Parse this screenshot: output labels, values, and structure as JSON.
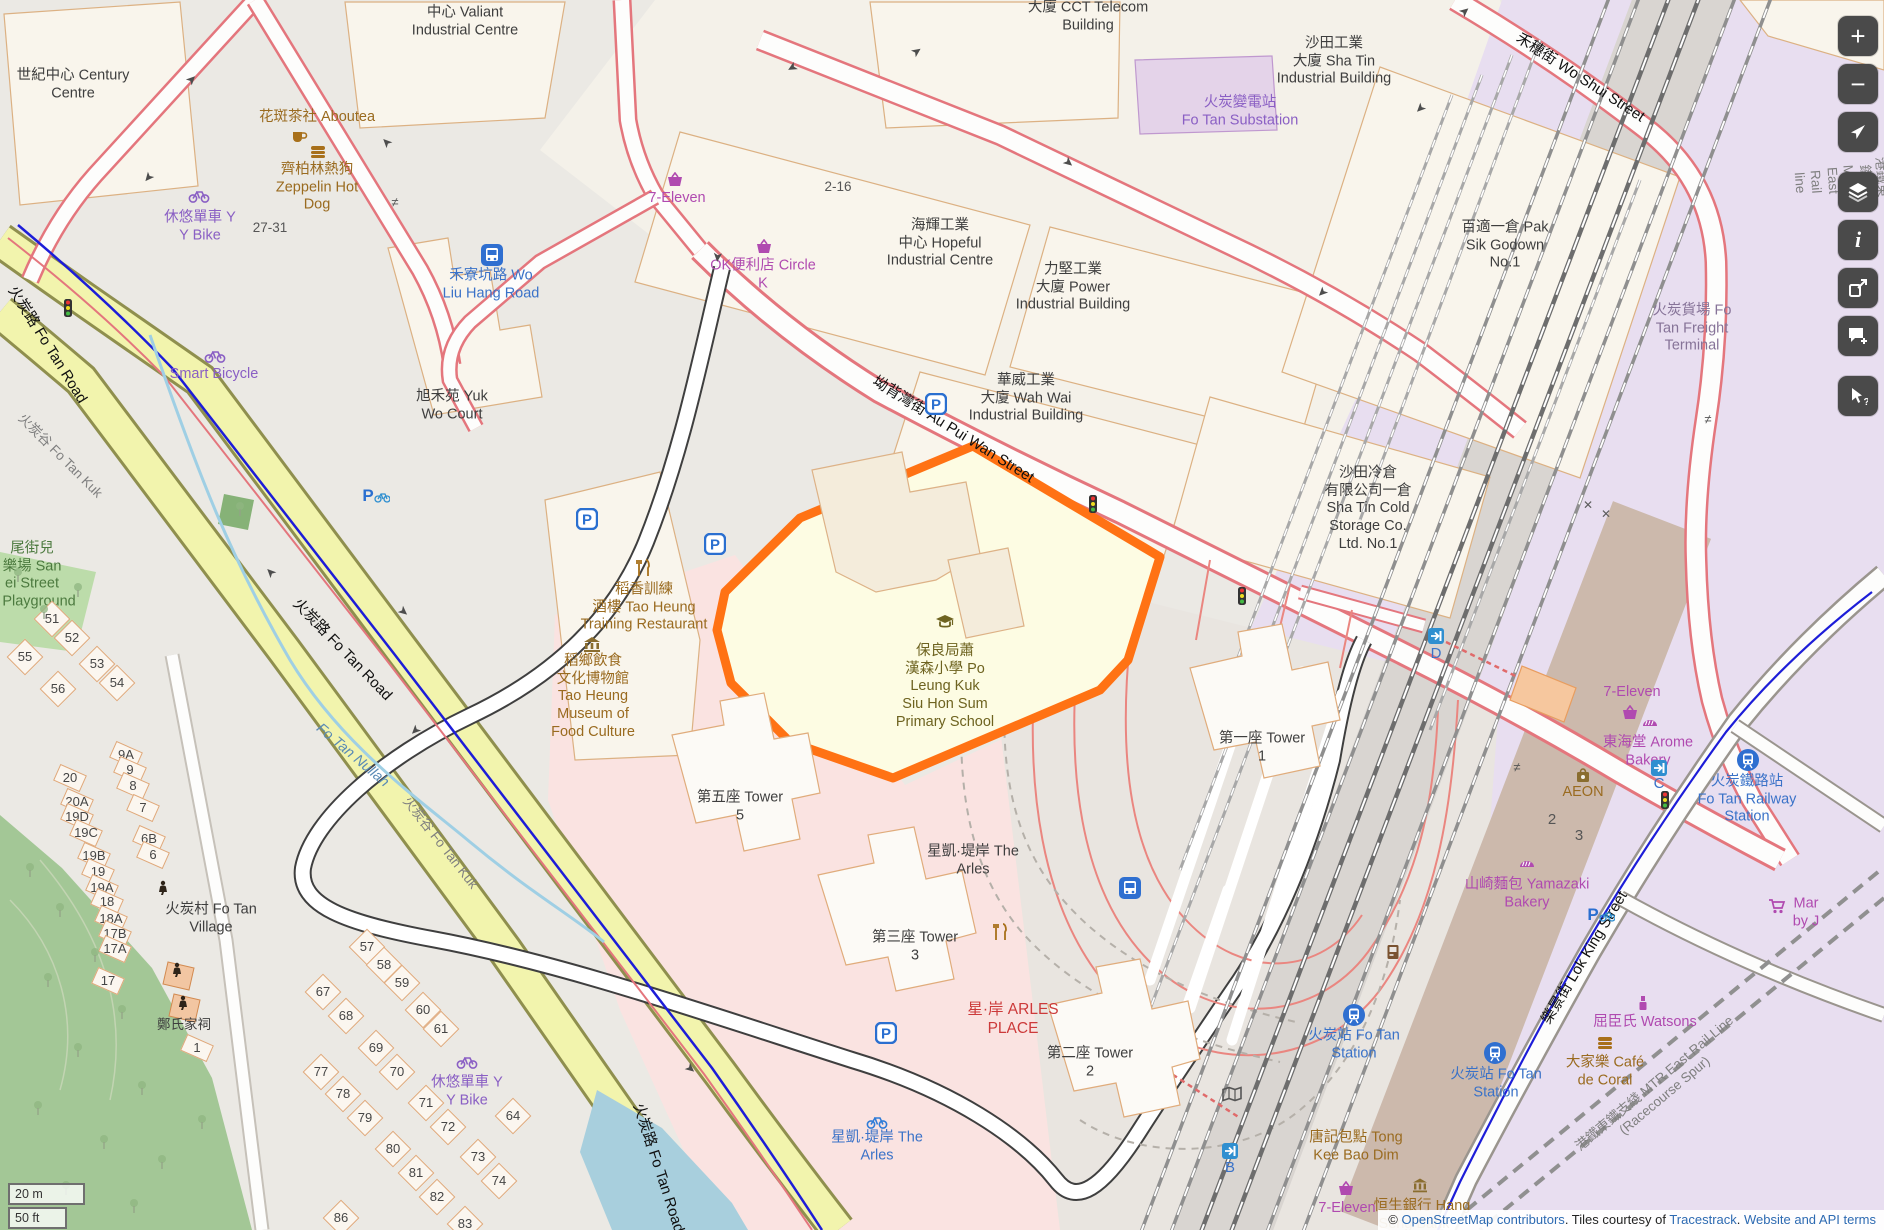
{
  "map": {
    "attribution": {
      "prefix": "© ",
      "link_osm": "OpenStreetMap contributors",
      "middle": ". Tiles courtesy of ",
      "link_tiles": "Tracestrack",
      "sep": ". ",
      "link_terms": "Website and API terms"
    },
    "scale": {
      "metric": "20 m",
      "imperial": "50 ft"
    },
    "colors": {
      "highlight": "#ff7214",
      "school_fill": "#fdfce3",
      "rail_land": "#e8def0",
      "water": "#a8cfdd"
    },
    "controls": {
      "groups": [
        {
          "items": [
            {
              "id": "zoom-in",
              "g": "plus"
            },
            {
              "id": "zoom-out",
              "g": "minus"
            },
            {
              "id": "locate",
              "g": "nav"
            }
          ]
        },
        {
          "items": [
            {
              "id": "layers",
              "g": "layers"
            },
            {
              "id": "legend",
              "g": "info"
            },
            {
              "id": "share",
              "g": "share"
            },
            {
              "id": "note",
              "g": "note"
            }
          ]
        },
        {
          "items": [
            {
              "id": "query-features",
              "g": "query"
            }
          ]
        }
      ]
    }
  },
  "labels": [
    {
      "t": [
        "世紀中心 Century",
        "Centre"
      ],
      "x": 73,
      "y": 85,
      "c": "place"
    },
    {
      "t": [
        "中心 Valiant",
        "Industrial Centre"
      ],
      "x": 465,
      "y": 22,
      "c": "place"
    },
    {
      "t": [
        "大廈 CCT Telecom",
        "Building"
      ],
      "x": 1088,
      "y": 17,
      "c": "place"
    },
    {
      "t": [
        "沙田工業",
        "大廈 Sha Tin",
        "Industrial Building"
      ],
      "x": 1334,
      "y": 62,
      "c": "place"
    },
    {
      "t": [
        "百適一倉 Pak",
        "Sik Godown",
        "No.1"
      ],
      "x": 1505,
      "y": 246,
      "c": "place"
    },
    {
      "t": [
        "海輝工業",
        "中心 Hopeful",
        "Industrial Centre"
      ],
      "x": 940,
      "y": 244,
      "c": "place"
    },
    {
      "t": [
        "力堅工業",
        "大廈 Power",
        "Industrial Building"
      ],
      "x": 1073,
      "y": 288,
      "c": "place"
    },
    {
      "t": [
        "華威工業",
        "大廈 Wah Wai",
        "Industrial Building"
      ],
      "x": 1026,
      "y": 399,
      "c": "place"
    },
    {
      "t": [
        "沙田冷倉",
        "有限公司一倉",
        "Sha Tin Cold",
        "Storage Co.",
        "Ltd. No.1"
      ],
      "x": 1368,
      "y": 509,
      "c": "place"
    },
    {
      "t": [
        "旭禾苑 Yuk",
        "Wo Court"
      ],
      "x": 452,
      "y": 406,
      "c": "place"
    },
    {
      "t": [
        "第五座 Tower",
        "5"
      ],
      "x": 740,
      "y": 807,
      "c": "place"
    },
    {
      "t": [
        "星凱·堤岸 The",
        "Arles"
      ],
      "x": 973,
      "y": 861,
      "c": "place"
    },
    {
      "t": [
        "第三座 Tower",
        "3"
      ],
      "x": 915,
      "y": 947,
      "c": "place"
    },
    {
      "t": [
        "第二座 Tower",
        "2"
      ],
      "x": 1090,
      "y": 1063,
      "c": "place"
    },
    {
      "t": [
        "第一座 Tower",
        "1"
      ],
      "x": 1262,
      "y": 748,
      "c": "place"
    },
    {
      "t": [
        "火炭村 Fo Tan",
        "Village"
      ],
      "x": 211,
      "y": 919,
      "c": "place"
    },
    {
      "t": [
        "保良局蕭",
        "漢森小學 Po",
        "Leung Kuk",
        "Siu Hon Sum",
        "Primary School"
      ],
      "x": 945,
      "y": 687,
      "c": "school"
    },
    {
      "t": "27-31",
      "x": 270,
      "y": 228,
      "c": "numplain"
    },
    {
      "t": "2-16",
      "x": 838,
      "y": 187,
      "c": "numplain"
    },
    {
      "t": "2",
      "x": 1552,
      "y": 820,
      "c": "numplain",
      "s": 15
    },
    {
      "t": "3",
      "x": 1579,
      "y": 836,
      "c": "numplain",
      "s": 15
    },
    {
      "t": "火炭路 Fo Tan Road",
      "x": 47,
      "y": 345,
      "c": "street",
      "r": 58
    },
    {
      "t": "火炭路 Fo Tan Road",
      "x": 342,
      "y": 650,
      "c": "street",
      "r": 46
    },
    {
      "t": "火炭路 Fo Tan Road",
      "x": 658,
      "y": 1168,
      "c": "street",
      "r": 72
    },
    {
      "t": "坳背灣街 Au Pui Wan Street",
      "x": 953,
      "y": 430,
      "c": "street",
      "r": 32
    },
    {
      "t": "禾穗街 Wo Shui Street",
      "x": 1580,
      "y": 78,
      "c": "street",
      "r": 33
    },
    {
      "t": "樂景街 Lok King Street",
      "x": 1585,
      "y": 958,
      "c": "street",
      "r": -59
    },
    {
      "t": "花斑茶社 Aboutea",
      "x": 317,
      "y": 118,
      "c": "poib"
    },
    {
      "t": [
        "齊柏林熱狗",
        "Zeppelin Hot",
        "Dog"
      ],
      "x": 317,
      "y": 188,
      "c": "poib"
    },
    {
      "t": [
        "稻香訓練",
        "酒樓 Tao Heung",
        "Training Restaurant"
      ],
      "x": 644,
      "y": 608,
      "c": "poib"
    },
    {
      "t": [
        "稻鄉飲食",
        "文化博物館",
        "Tao Heung",
        "Museum of",
        "Food Culture"
      ],
      "x": 593,
      "y": 697,
      "c": "poib"
    },
    {
      "t": "AEON",
      "x": 1583,
      "y": 793,
      "c": "poib"
    },
    {
      "t": [
        "大家樂 Café",
        "de Coral"
      ],
      "x": 1605,
      "y": 1072,
      "c": "poib"
    },
    {
      "t": [
        "唐記包點 Tong",
        "Kee Bao Dim"
      ],
      "x": 1356,
      "y": 1147,
      "c": "poib"
    },
    {
      "t": "恒生銀行 Hang",
      "x": 1422,
      "y": 1207,
      "c": "poib"
    },
    {
      "t": "Seng Bank",
      "x": 1414,
      "y": 1225,
      "c": "poib"
    },
    {
      "t": "7-Eleven",
      "x": 677,
      "y": 199,
      "c": "poip"
    },
    {
      "t": [
        "OK便利店 Circle",
        "K"
      ],
      "x": 763,
      "y": 275,
      "c": "poip"
    },
    {
      "t": "Smart Bicycle",
      "x": 214,
      "y": 375,
      "c": "poiv"
    },
    {
      "t": [
        "休悠單車 Y",
        "Y Bike"
      ],
      "x": 200,
      "y": 227,
      "c": "poiv"
    },
    {
      "t": [
        "休悠單車 Y",
        "Y Bike"
      ],
      "x": 467,
      "y": 1092,
      "c": "poiv"
    },
    {
      "t": [
        "火炭變電站",
        "Fo Tan Substation"
      ],
      "x": 1240,
      "y": 112,
      "c": "poiv"
    },
    {
      "t": [
        "山崎麵包 Yamazaki",
        "Bakery"
      ],
      "x": 1527,
      "y": 894,
      "c": "poip"
    },
    {
      "t": [
        "東海堂 Arome",
        "Bakery"
      ],
      "x": 1648,
      "y": 752,
      "c": "poip"
    },
    {
      "t": "7-Eleven",
      "x": 1632,
      "y": 693,
      "c": "poip"
    },
    {
      "t": "7-Eleven",
      "x": 1347,
      "y": 1209,
      "c": "poip"
    },
    {
      "t": "屈臣氏 Watsons",
      "x": 1645,
      "y": 1023,
      "c": "poip"
    },
    {
      "t": [
        "Mar",
        "by J"
      ],
      "x": 1806,
      "y": 913,
      "c": "poip"
    },
    {
      "t": [
        "火炭貨場 Fo",
        "Tan Freight",
        "Terminal"
      ],
      "x": 1692,
      "y": 329,
      "c": "railp"
    },
    {
      "t": [
        "禾寮坑路 Wo",
        "Liu Hang Road"
      ],
      "x": 491,
      "y": 285,
      "c": "poibl"
    },
    {
      "t": [
        "火炭鐵路站",
        "Fo Tan Railway",
        "Station"
      ],
      "x": 1747,
      "y": 800,
      "c": "poibl"
    },
    {
      "t": [
        "火炭站 Fo Tan",
        "Station"
      ],
      "x": 1354,
      "y": 1045,
      "c": "poibl"
    },
    {
      "t": [
        "火炭站 Fo Tan",
        "Station"
      ],
      "x": 1496,
      "y": 1084,
      "c": "poibl"
    },
    {
      "t": [
        "星凱·堤岸 The",
        "Arles"
      ],
      "x": 877,
      "y": 1147,
      "c": "poibl"
    },
    {
      "t": "D",
      "x": 1436,
      "y": 654,
      "c": "poibl",
      "s": 15
    },
    {
      "t": "B",
      "x": 1230,
      "y": 1168,
      "c": "poibl",
      "s": 15
    },
    {
      "t": "C",
      "x": 1659,
      "y": 784,
      "c": "poibl",
      "s": 15
    },
    {
      "t": [
        "星·岸 ARLES",
        "PLACE"
      ],
      "x": 1013,
      "y": 1020,
      "c": "poir"
    },
    {
      "t": [
        "尾街兒",
        "樂場 San",
        "ei Street",
        "'s Playground"
      ],
      "x": 32,
      "y": 576,
      "c": "poig"
    },
    {
      "t": "Fo Tan Nullah",
      "x": 352,
      "y": 756,
      "c": "wat",
      "r": 40
    },
    {
      "t": "火炭谷 Fo Tan Kuk",
      "x": 60,
      "y": 456,
      "c": "gry",
      "r": 45
    },
    {
      "t": "火炭谷 Fo Tan Kuk",
      "x": 440,
      "y": 843,
      "c": "gry",
      "r": 52
    },
    {
      "t": "港鐵東鐵綫 MTR East Rail line",
      "x": 1840,
      "y": 180,
      "c": "gry",
      "r": 86
    },
    {
      "t": "港鐵東鐵支綫 MTR East Rail Line (Racecourse Spur)",
      "x": 1660,
      "y": 1090,
      "c": "gry",
      "r": -40
    },
    {
      "t": "51",
      "x": 52,
      "y": 619,
      "c": "num"
    },
    {
      "t": "52",
      "x": 72,
      "y": 638,
      "c": "num"
    },
    {
      "t": "55",
      "x": 25,
      "y": 657,
      "c": "num"
    },
    {
      "t": "53",
      "x": 97,
      "y": 664,
      "c": "num"
    },
    {
      "t": "54",
      "x": 117,
      "y": 683,
      "c": "num"
    },
    {
      "t": "56",
      "x": 58,
      "y": 689,
      "c": "num"
    },
    {
      "t": "57",
      "x": 367,
      "y": 947,
      "c": "num"
    },
    {
      "t": "58",
      "x": 384,
      "y": 965,
      "c": "num"
    },
    {
      "t": "59",
      "x": 402,
      "y": 983,
      "c": "num"
    },
    {
      "t": "60",
      "x": 423,
      "y": 1010,
      "c": "num"
    },
    {
      "t": "61",
      "x": 441,
      "y": 1029,
      "c": "num"
    },
    {
      "t": "67",
      "x": 323,
      "y": 992,
      "c": "num"
    },
    {
      "t": "68",
      "x": 346,
      "y": 1016,
      "c": "num"
    },
    {
      "t": "69",
      "x": 376,
      "y": 1048,
      "c": "num"
    },
    {
      "t": "70",
      "x": 397,
      "y": 1072,
      "c": "num"
    },
    {
      "t": "71",
      "x": 426,
      "y": 1103,
      "c": "num"
    },
    {
      "t": "72",
      "x": 448,
      "y": 1127,
      "c": "num"
    },
    {
      "t": "64",
      "x": 513,
      "y": 1116,
      "c": "num"
    },
    {
      "t": "73",
      "x": 478,
      "y": 1157,
      "c": "num"
    },
    {
      "t": "74",
      "x": 499,
      "y": 1181,
      "c": "num"
    },
    {
      "t": "77",
      "x": 321,
      "y": 1072,
      "c": "num"
    },
    {
      "t": "78",
      "x": 343,
      "y": 1094,
      "c": "num"
    },
    {
      "t": "79",
      "x": 365,
      "y": 1118,
      "c": "num"
    },
    {
      "t": "80",
      "x": 393,
      "y": 1149,
      "c": "num"
    },
    {
      "t": "81",
      "x": 416,
      "y": 1173,
      "c": "num"
    },
    {
      "t": "82",
      "x": 437,
      "y": 1197,
      "c": "num"
    },
    {
      "t": "86",
      "x": 341,
      "y": 1218,
      "c": "num"
    },
    {
      "t": "83",
      "x": 465,
      "y": 1224,
      "c": "num"
    },
    {
      "t": "20",
      "x": 70,
      "y": 778,
      "c": "numr"
    },
    {
      "t": "20A",
      "x": 77,
      "y": 802,
      "c": "numr"
    },
    {
      "t": "19D",
      "x": 77,
      "y": 817,
      "c": "numr"
    },
    {
      "t": "19C",
      "x": 86,
      "y": 833,
      "c": "numr"
    },
    {
      "t": "19B",
      "x": 94,
      "y": 856,
      "c": "numr"
    },
    {
      "t": "19",
      "x": 98,
      "y": 872,
      "c": "numr"
    },
    {
      "t": "19A",
      "x": 102,
      "y": 888,
      "c": "numr"
    },
    {
      "t": "18",
      "x": 107,
      "y": 902,
      "c": "numr"
    },
    {
      "t": "18A",
      "x": 111,
      "y": 919,
      "c": "numr"
    },
    {
      "t": "17B",
      "x": 115,
      "y": 934,
      "c": "numr"
    },
    {
      "t": "17A",
      "x": 115,
      "y": 949,
      "c": "numr"
    },
    {
      "t": "17",
      "x": 108,
      "y": 981,
      "c": "numr"
    },
    {
      "t": "9A",
      "x": 126,
      "y": 755,
      "c": "numr"
    },
    {
      "t": "9",
      "x": 130,
      "y": 770,
      "c": "numr"
    },
    {
      "t": "8",
      "x": 133,
      "y": 786,
      "c": "numr"
    },
    {
      "t": "7",
      "x": 143,
      "y": 808,
      "c": "numr"
    },
    {
      "t": "6B",
      "x": 149,
      "y": 839,
      "c": "numr"
    },
    {
      "t": "6",
      "x": 153,
      "y": 855,
      "c": "numr"
    },
    {
      "t": "1",
      "x": 197,
      "y": 1048,
      "c": "numr"
    },
    {
      "t": "鄭氏家祠",
      "x": 184,
      "y": 1025,
      "c": "place",
      "s": 13.5
    }
  ],
  "icons": [
    {
      "k": "cup",
      "x": 299,
      "y": 137
    },
    {
      "k": "burger",
      "x": 318,
      "y": 152
    },
    {
      "k": "burger",
      "x": 1605,
      "y": 1043
    },
    {
      "k": "cutlery",
      "x": 643,
      "y": 568
    },
    {
      "k": "cutlery",
      "x": 1000,
      "y": 932
    },
    {
      "k": "museum",
      "x": 592,
      "y": 644
    },
    {
      "k": "basket",
      "x": 675,
      "y": 180
    },
    {
      "k": "basket",
      "x": 764,
      "y": 247
    },
    {
      "k": "basket",
      "x": 1630,
      "y": 713
    },
    {
      "k": "basket",
      "x": 1346,
      "y": 1189
    },
    {
      "k": "bread",
      "x": 1650,
      "y": 722
    },
    {
      "k": "bread",
      "x": 1527,
      "y": 863
    },
    {
      "k": "cart",
      "x": 1777,
      "y": 906
    },
    {
      "k": "cosmetics",
      "x": 1643,
      "y": 1003
    },
    {
      "k": "bag",
      "x": 1583,
      "y": 775
    },
    {
      "k": "bank",
      "x": 1420,
      "y": 1185
    },
    {
      "k": "vending",
      "x": 1393,
      "y": 952
    },
    {
      "k": "mapfold",
      "x": 1232,
      "y": 1094
    },
    {
      "k": "bike",
      "x": 199,
      "y": 196
    },
    {
      "k": "bike",
      "x": 215,
      "y": 356
    },
    {
      "k": "bike",
      "x": 467,
      "y": 1062
    },
    {
      "k": "bikeshare",
      "x": 877,
      "y": 1122
    },
    {
      "k": "bus",
      "x": 492,
      "y": 255
    },
    {
      "k": "bus",
      "x": 1130,
      "y": 888
    },
    {
      "k": "train",
      "x": 1748,
      "y": 760
    },
    {
      "k": "train",
      "x": 1354,
      "y": 1015
    },
    {
      "k": "train",
      "x": 1495,
      "y": 1053
    },
    {
      "k": "entrance",
      "x": 1436,
      "y": 636
    },
    {
      "k": "entrance",
      "x": 1230,
      "y": 1151
    },
    {
      "k": "entrance",
      "x": 1659,
      "y": 768
    },
    {
      "k": "parking",
      "x": 587,
      "y": 519
    },
    {
      "k": "parking",
      "x": 715,
      "y": 544
    },
    {
      "k": "parking",
      "x": 936,
      "y": 404
    },
    {
      "k": "parking",
      "x": 886,
      "y": 1033
    },
    {
      "k": "parkbike",
      "x": 376,
      "y": 495
    },
    {
      "k": "parkbike",
      "x": 1601,
      "y": 914
    },
    {
      "k": "tlight",
      "x": 68,
      "y": 308
    },
    {
      "k": "tlight",
      "x": 1093,
      "y": 504
    },
    {
      "k": "tlight",
      "x": 1242,
      "y": 596
    },
    {
      "k": "tlight",
      "x": 1665,
      "y": 800
    },
    {
      "k": "schoolicon",
      "x": 945,
      "y": 622
    },
    {
      "k": "temple",
      "x": 163,
      "y": 888
    },
    {
      "k": "temple",
      "x": 177,
      "y": 970
    },
    {
      "k": "temple",
      "x": 183,
      "y": 1003
    },
    {
      "k": "tree",
      "x": 18,
      "y": 575
    },
    {
      "k": "tree",
      "x": 44,
      "y": 612
    },
    {
      "k": "tree",
      "x": 78,
      "y": 590
    },
    {
      "k": "tree",
      "x": 30,
      "y": 870
    },
    {
      "k": "tree",
      "x": 60,
      "y": 910
    },
    {
      "k": "tree",
      "x": 95,
      "y": 955
    },
    {
      "k": "tree",
      "x": 48,
      "y": 980
    },
    {
      "k": "tree",
      "x": 122,
      "y": 1012
    },
    {
      "k": "tree",
      "x": 78,
      "y": 1050
    },
    {
      "k": "tree",
      "x": 142,
      "y": 1088
    },
    {
      "k": "tree",
      "x": 38,
      "y": 1108
    },
    {
      "k": "tree",
      "x": 104,
      "y": 1142
    },
    {
      "k": "tree",
      "x": 162,
      "y": 1162
    },
    {
      "k": "tree",
      "x": 66,
      "y": 1188
    },
    {
      "k": "tree",
      "x": 134,
      "y": 1206
    },
    {
      "k": "tree",
      "x": 202,
      "y": 1122
    },
    {
      "k": "tree",
      "x": 240,
      "y": 509
    },
    {
      "k": "arrow",
      "x": 192,
      "y": 80,
      "r": -45
    },
    {
      "k": "arrow",
      "x": 148,
      "y": 177,
      "r": 130
    },
    {
      "k": "arrow",
      "x": 387,
      "y": 142,
      "r": -135
    },
    {
      "k": "arrow",
      "x": 917,
      "y": 52,
      "r": -35
    },
    {
      "k": "arrow",
      "x": 792,
      "y": 67,
      "r": 150
    },
    {
      "k": "arrow",
      "x": 717,
      "y": 257,
      "r": 95
    },
    {
      "k": "arrow",
      "x": 1068,
      "y": 163,
      "r": 40
    },
    {
      "k": "arrow",
      "x": 1465,
      "y": 12,
      "r": -40
    },
    {
      "k": "arrow",
      "x": 1420,
      "y": 108,
      "r": 135
    },
    {
      "k": "arrow",
      "x": 1322,
      "y": 292,
      "r": 135
    },
    {
      "k": "arrow",
      "x": 271,
      "y": 572,
      "r": -135
    },
    {
      "k": "arrow",
      "x": 403,
      "y": 612,
      "r": 40
    },
    {
      "k": "arrow",
      "x": 415,
      "y": 730,
      "r": 135
    },
    {
      "k": "arrow",
      "x": 690,
      "y": 1069,
      "r": 40
    },
    {
      "k": "cross",
      "x": 1588,
      "y": 505
    },
    {
      "k": "cross",
      "x": 1606,
      "y": 514
    },
    {
      "k": "noteq",
      "x": 395,
      "y": 202
    },
    {
      "k": "noteq",
      "x": 1708,
      "y": 419
    },
    {
      "k": "noteq",
      "x": 1517,
      "y": 767
    }
  ]
}
